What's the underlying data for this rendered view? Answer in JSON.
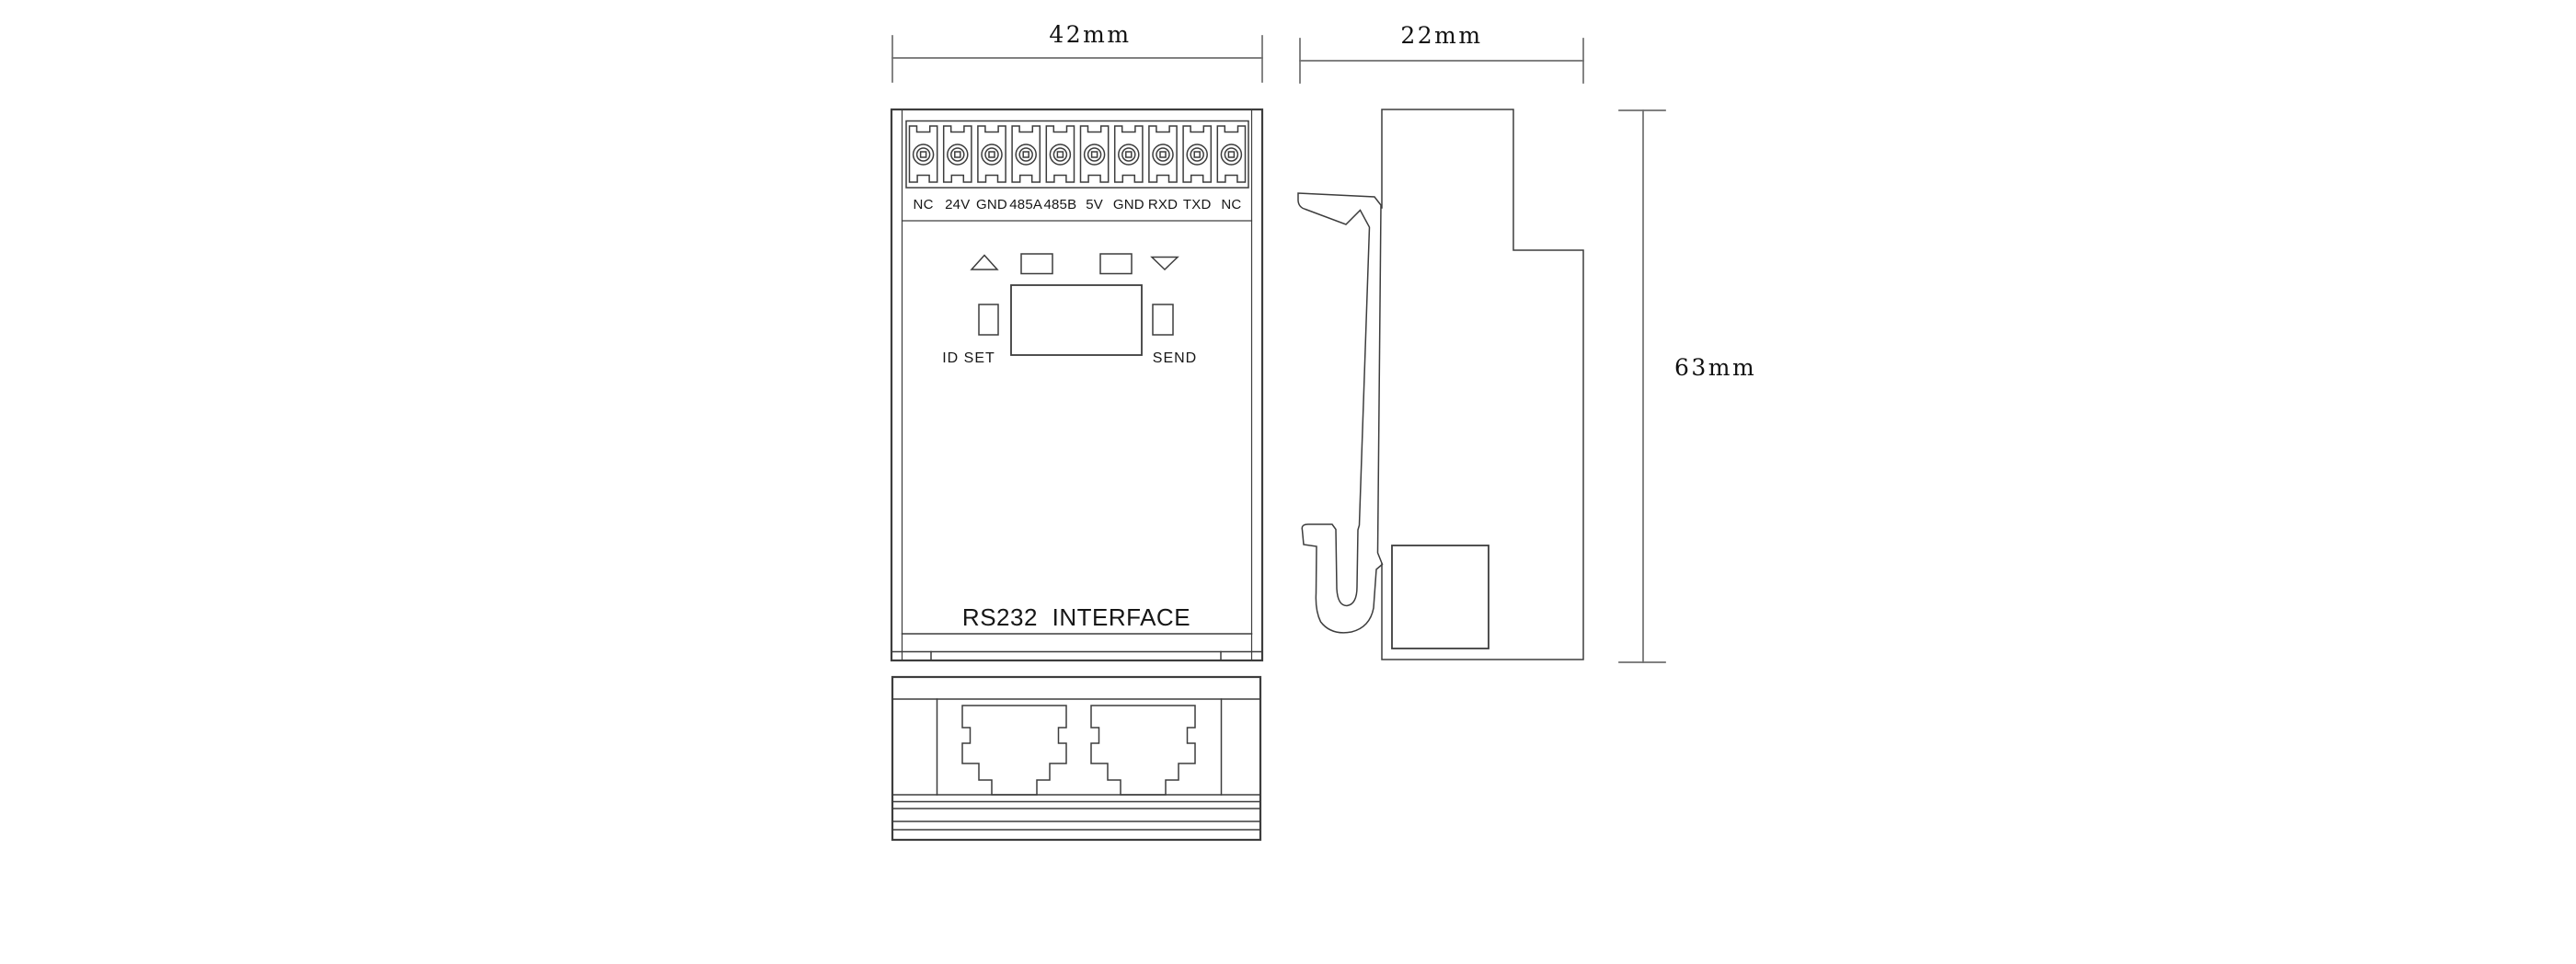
{
  "colors": {
    "line": "#3d3d3d",
    "dimension_line": "#6f6f6f",
    "text": "#161616",
    "background": "#ffffff"
  },
  "front_view": {
    "terminal_labels": [
      "NC",
      "24V",
      "GND",
      "485A",
      "485B",
      "5V",
      "GND",
      "RXD",
      "TXD",
      "NC"
    ],
    "id_set_label": "ID SET",
    "send_label": "SEND",
    "panel_label": "RS232 INTERFACE"
  },
  "dimensions": {
    "front_width": "42mm",
    "side_width": "22mm",
    "side_height": "63mm"
  }
}
